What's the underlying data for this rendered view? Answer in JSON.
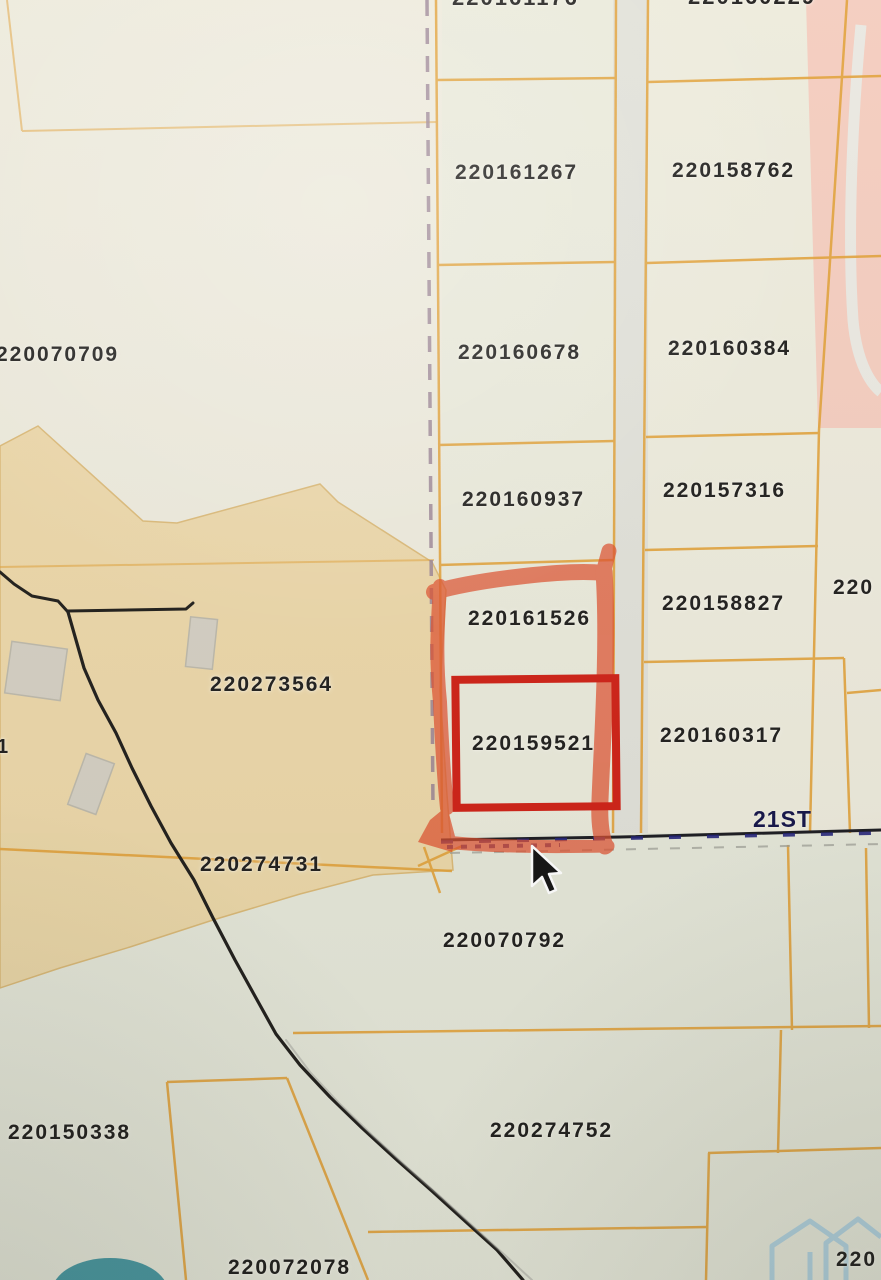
{
  "street": {
    "label": "21ST"
  },
  "labels": [
    {
      "name": "parcel-label-220161176-cut",
      "text": "220161176",
      "x": 452,
      "y": -13,
      "size": 22
    },
    {
      "name": "parcel-label-220160229-cut",
      "text": "220160229",
      "x": 688,
      "y": -14,
      "size": 22
    },
    {
      "name": "parcel-label-220161267",
      "text": "220161267",
      "x": 455,
      "y": 162,
      "size": 21
    },
    {
      "name": "parcel-label-220158762",
      "text": "220158762",
      "x": 672,
      "y": 160,
      "size": 21
    },
    {
      "name": "parcel-label-220070709",
      "text": "220070709",
      "x": -4,
      "y": 344,
      "size": 21
    },
    {
      "name": "parcel-label-220160678",
      "text": "220160678",
      "x": 458,
      "y": 342,
      "size": 21
    },
    {
      "name": "parcel-label-220160384",
      "text": "220160384",
      "x": 668,
      "y": 338,
      "size": 21
    },
    {
      "name": "parcel-label-220160937",
      "text": "220160937",
      "x": 462,
      "y": 489,
      "size": 21
    },
    {
      "name": "parcel-label-220157316",
      "text": "220157316",
      "x": 663,
      "y": 480,
      "size": 21
    },
    {
      "name": "parcel-label-220158827",
      "text": "220158827",
      "x": 662,
      "y": 593,
      "size": 21
    },
    {
      "name": "parcel-label-220-right",
      "text": "220",
      "x": 833,
      "y": 577,
      "size": 21
    },
    {
      "name": "parcel-label-220161526",
      "text": "220161526",
      "x": 468,
      "y": 608,
      "size": 21
    },
    {
      "name": "parcel-label-220273564",
      "text": "220273564",
      "x": 210,
      "y": 674,
      "size": 21
    },
    {
      "name": "parcel-label-220159521",
      "text": "220159521",
      "x": 472,
      "y": 733,
      "size": 21
    },
    {
      "name": "parcel-label-220160317",
      "text": "220160317",
      "x": 660,
      "y": 725,
      "size": 21
    },
    {
      "name": "partial-label-1",
      "text": "1",
      "x": -3,
      "y": 737,
      "size": 20
    },
    {
      "name": "parcel-label-220274731",
      "text": "220274731",
      "x": 200,
      "y": 854,
      "size": 21
    },
    {
      "name": "parcel-label-220070792",
      "text": "220070792",
      "x": 443,
      "y": 930,
      "size": 21
    },
    {
      "name": "parcel-label-220150338",
      "text": "220150338",
      "x": 8,
      "y": 1122,
      "size": 21
    },
    {
      "name": "parcel-label-220274752",
      "text": "220274752",
      "x": 490,
      "y": 1120,
      "size": 21
    },
    {
      "name": "parcel-label-220072078",
      "text": "220072078",
      "x": 228,
      "y": 1257,
      "size": 21
    },
    {
      "name": "parcel-label-220-bottom",
      "text": "220",
      "x": 836,
      "y": 1249,
      "size": 21
    }
  ],
  "colors": {
    "bg_cream": "#edeadc",
    "bg_below_street": "#e3e6d8",
    "bg_left_column": "#e7eadb",
    "bg_right_column": "#edebdc",
    "bg_road_gap": "#dfe0d8",
    "bg_tan": "#ecd5a2",
    "bg_pink": "#f5c6b8",
    "line_orange": "#e2a23b",
    "line_faint_orange": "#d9b36a",
    "boundary_black": "#211f1c",
    "dashed_purple": "#9a8494",
    "street_black": "#1c1c22",
    "street_navy": "#23237a",
    "street_gray": "#9b9b93",
    "highlight_marker": "#e0512f",
    "highlight_box": "#cf2217",
    "label_text": "#21201e",
    "street_text": "#15154a",
    "building_gray": "#d2cfc6",
    "building_edge": "#b9b6ac",
    "road_curve_white": "#e9e9e3",
    "watermark_blue": "#a5cce0",
    "teal_blob": "#2e8a96"
  }
}
